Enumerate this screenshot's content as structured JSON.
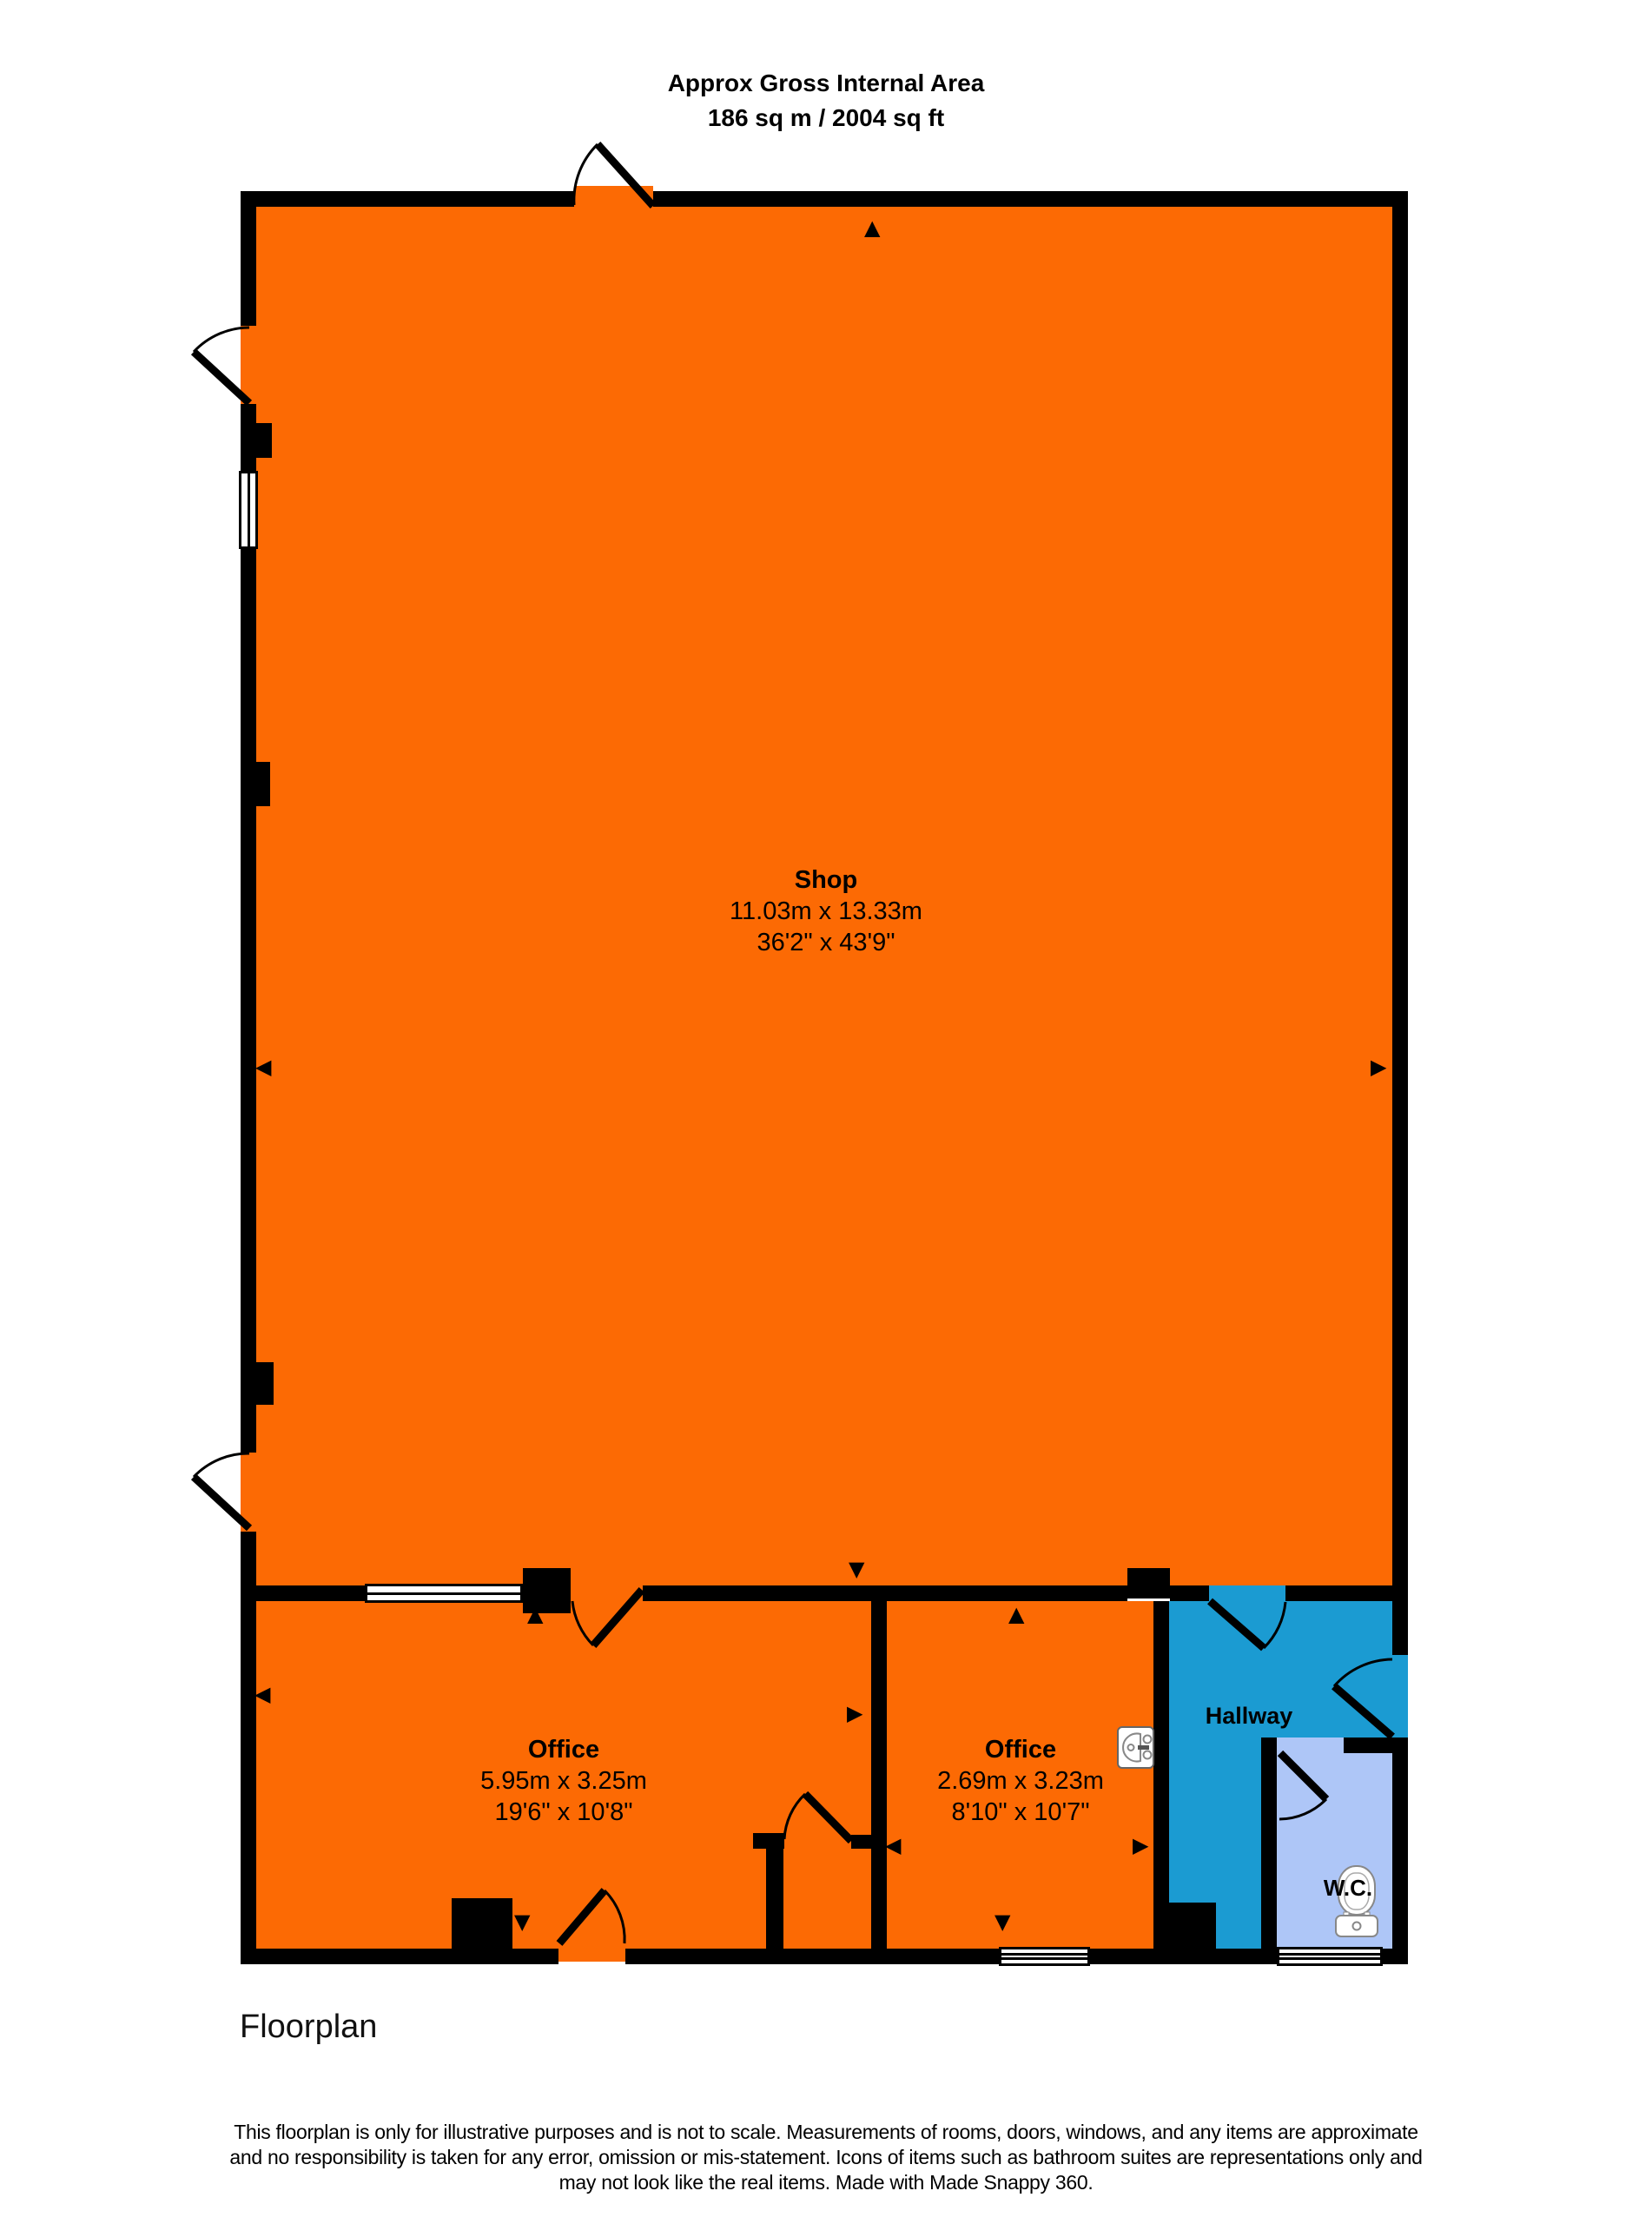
{
  "header": {
    "line1": "Approx Gross Internal Area",
    "line2": "186 sq m / 2004 sq ft"
  },
  "rooms": {
    "shop": {
      "name": "Shop",
      "metric": "11.03m x 13.33m",
      "imperial": "36'2\" x 43'9\""
    },
    "office1": {
      "name": "Office",
      "metric": "5.95m x 3.25m",
      "imperial": "19'6\" x 10'8\""
    },
    "office2": {
      "name": "Office",
      "metric": "2.69m x 3.23m",
      "imperial": "8'10\" x 10'7\""
    },
    "hallway": {
      "name": "Hallway"
    },
    "wc": {
      "name": "W.C."
    }
  },
  "arrows": {
    "up": "▲",
    "down": "▼",
    "left": "◀",
    "right": "▶"
  },
  "icons": {
    "toilet": "toilet-icon",
    "sink": "sink-icon"
  },
  "footer": {
    "caption": "Floorplan",
    "disclaimer_line1": "This floorplan is only for illustrative purposes and is not to scale. Measurements of rooms, doors, windows, and any items are approximate",
    "disclaimer_line2": "and no responsibility is taken for any error, omission or mis-statement. Icons of items such as bathroom suites are representations only and",
    "disclaimer_line3": "may not look like the real items. Made with Made Snappy 360."
  },
  "colors": {
    "room_orange": "#FC6A04",
    "hallway_blue": "#1B9BD2",
    "wc_blue": "#AEC6F7",
    "wall": "#000000"
  }
}
